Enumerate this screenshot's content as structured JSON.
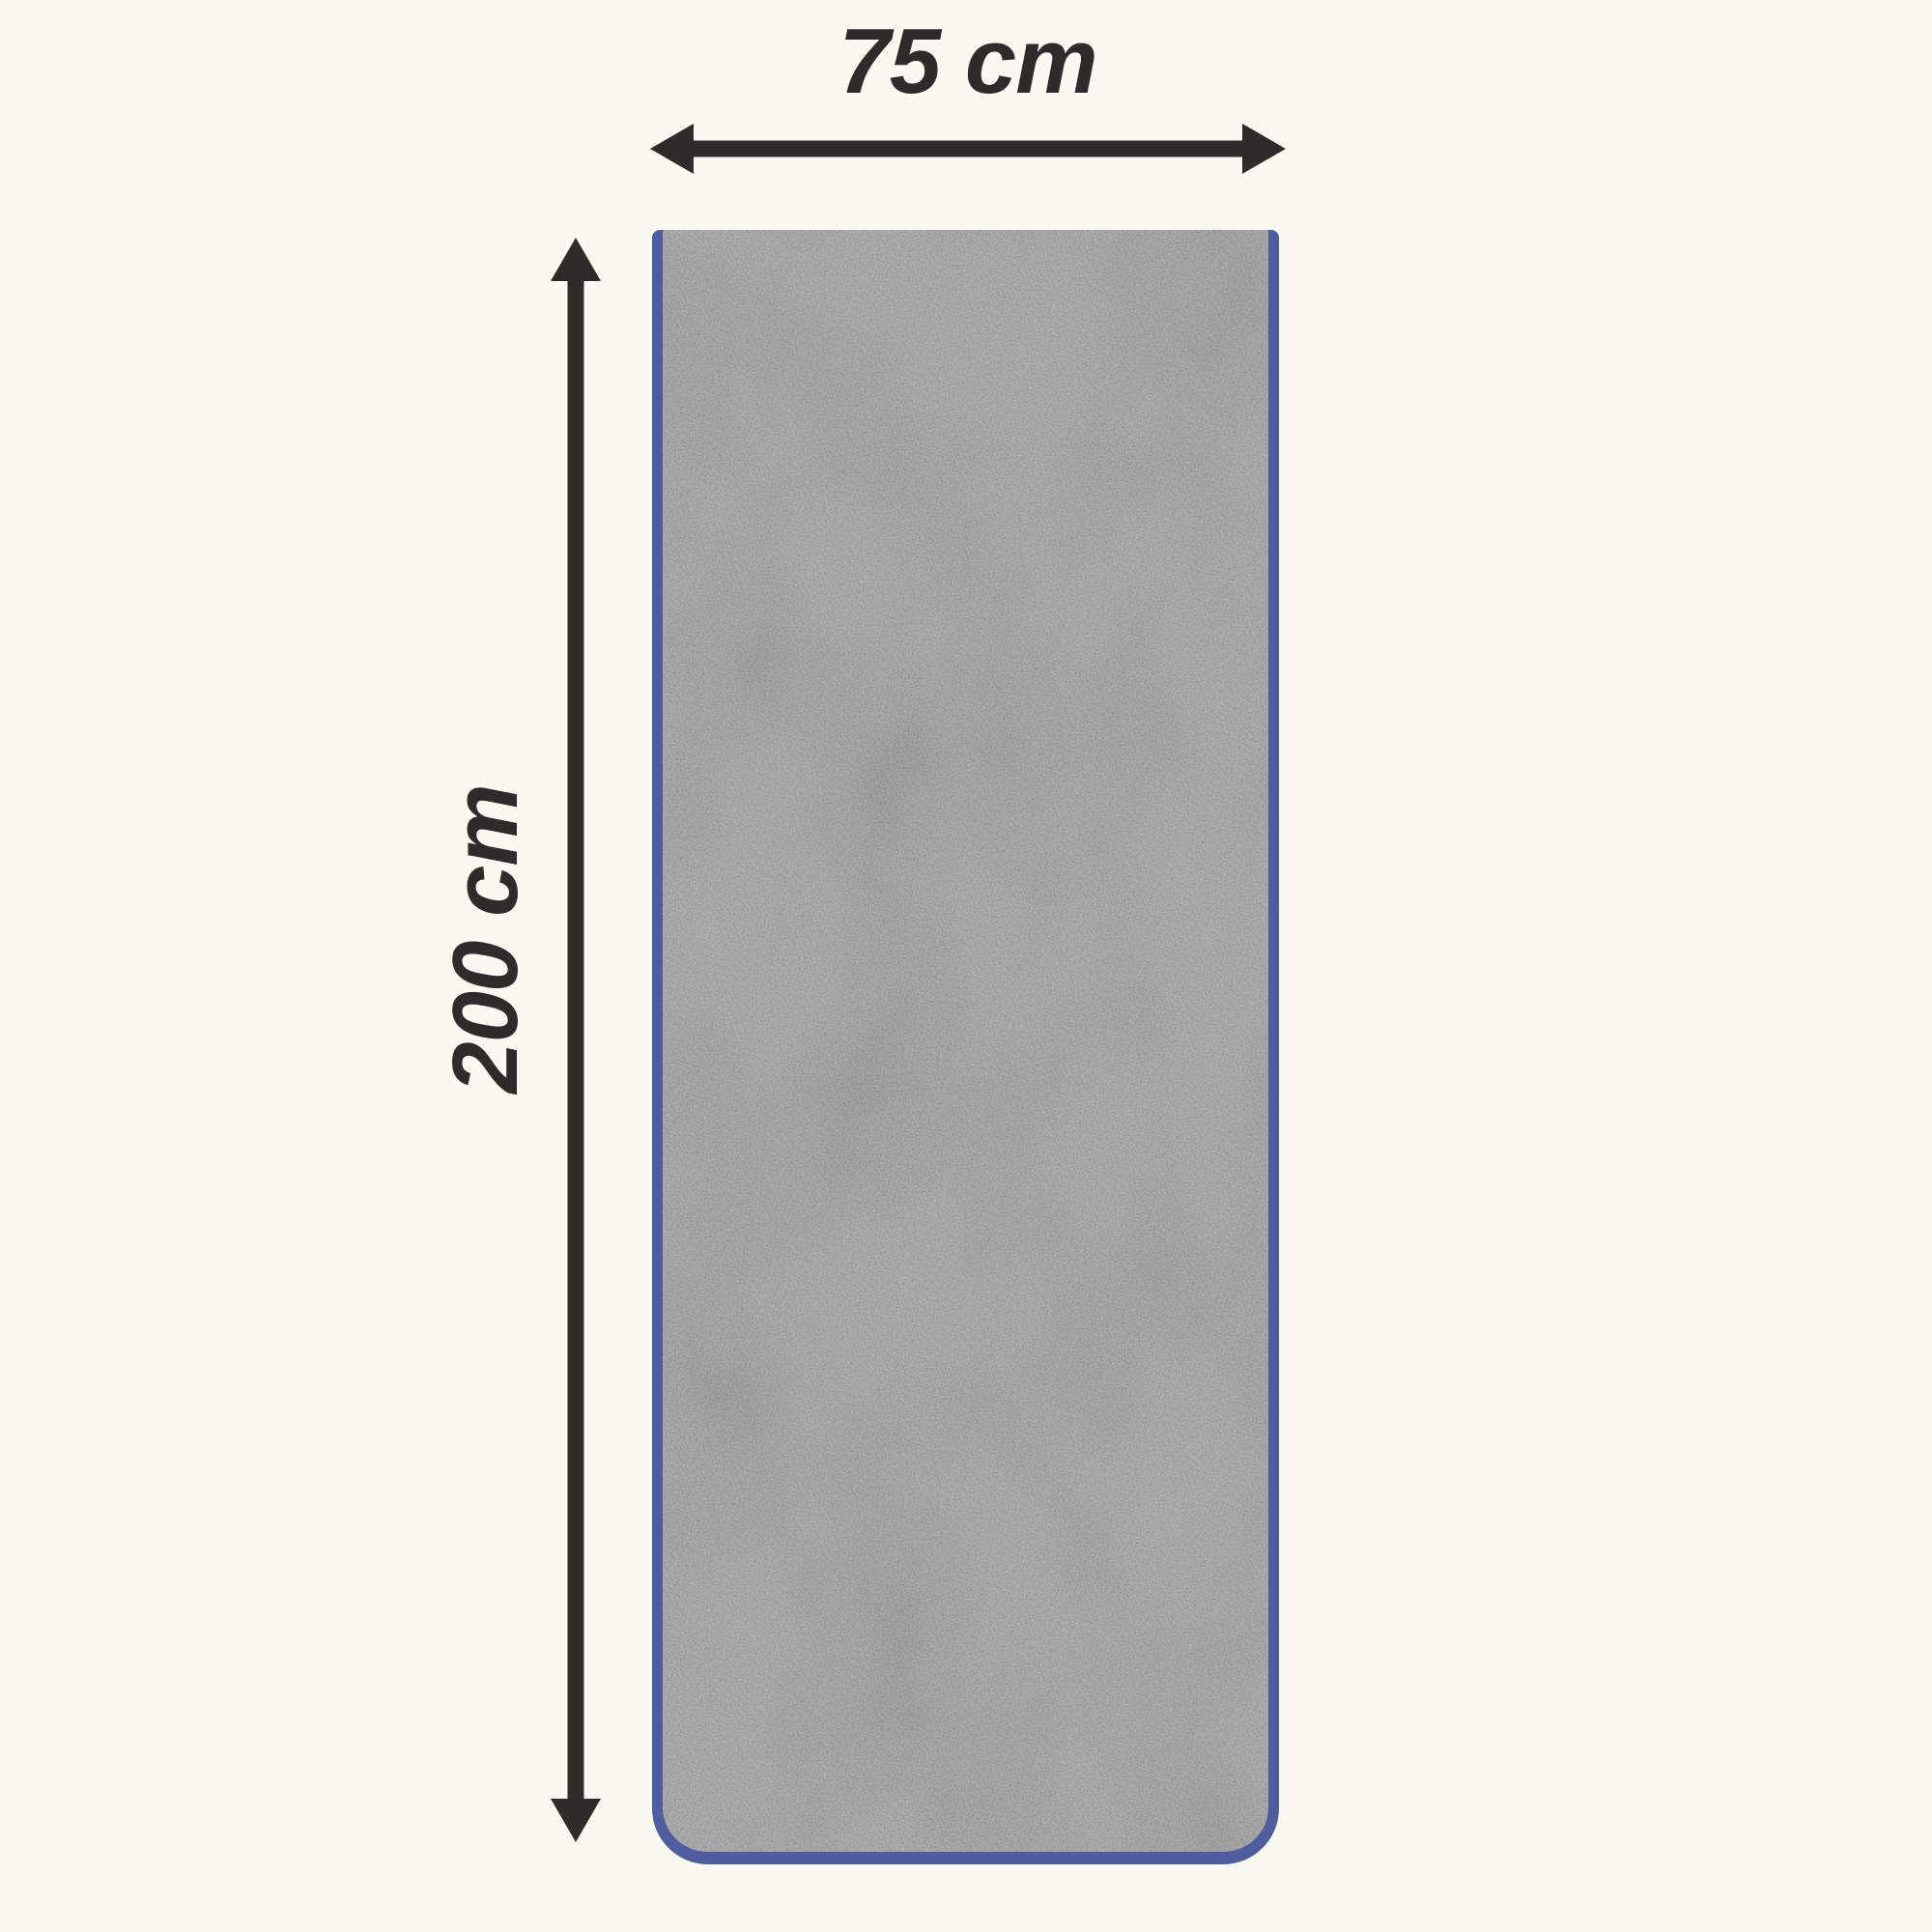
{
  "colors": {
    "background": "#f9f9f2",
    "ink": "#2e2c2a",
    "towel_fabric": "#8c8c8c",
    "towel_trim": "#4e5d9d"
  },
  "diagram": {
    "subject": "gray towel with blue trim, top-down view",
    "dimensions": {
      "width": {
        "label": "75 cm",
        "value": 75,
        "unit": "cm"
      },
      "height": {
        "label": "200 cm",
        "value": 200,
        "unit": "cm"
      }
    }
  }
}
